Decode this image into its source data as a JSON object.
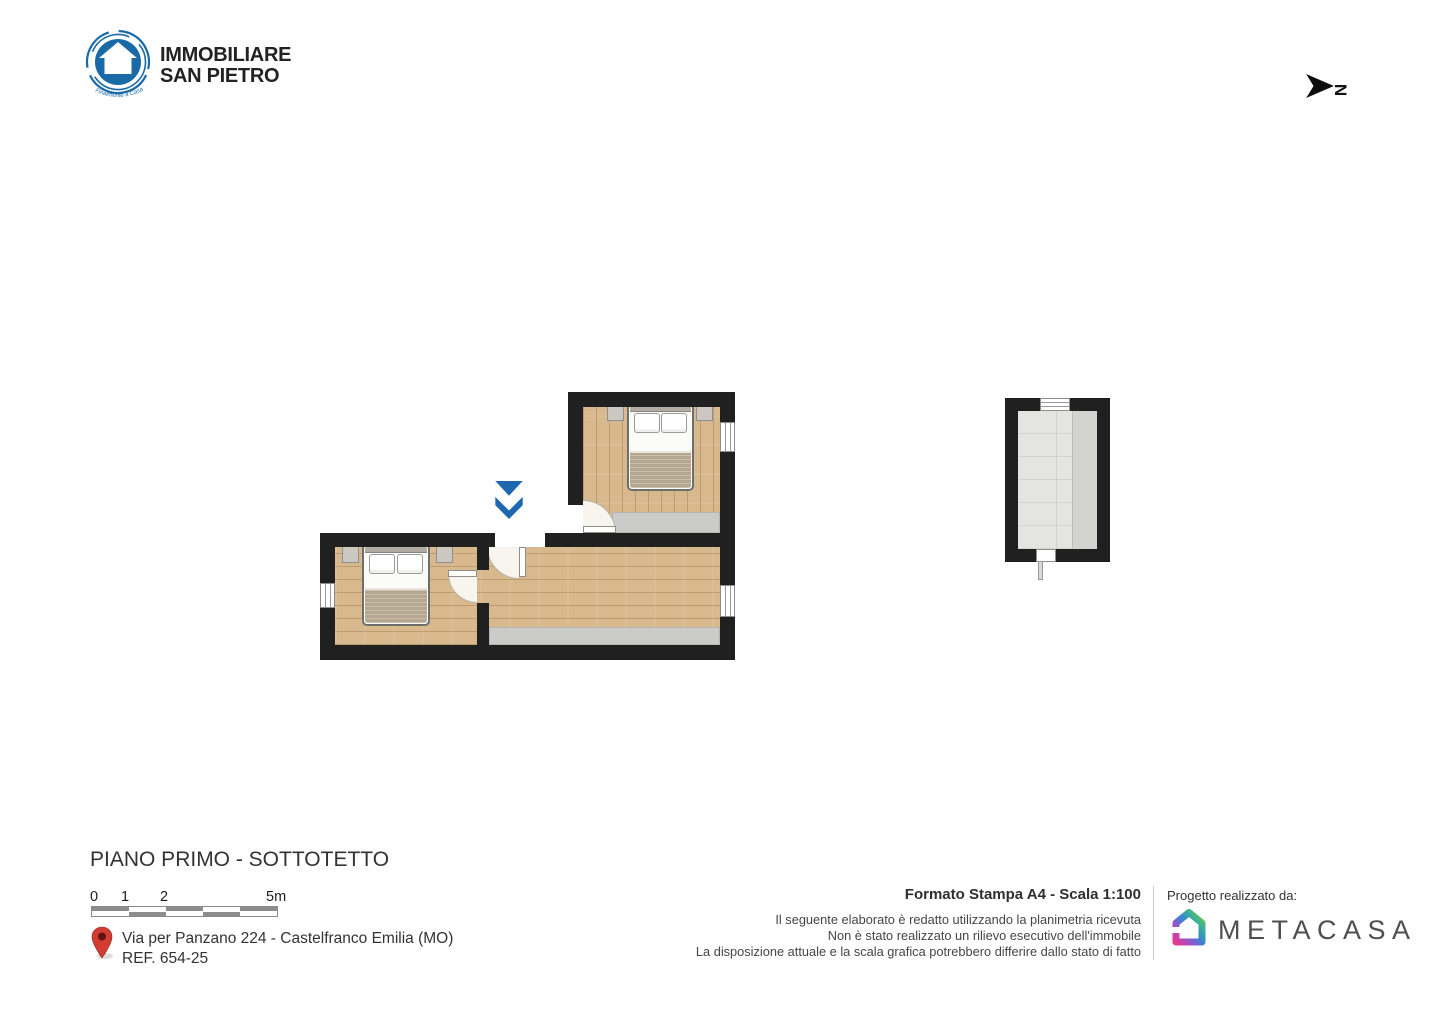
{
  "header": {
    "agency_logo": {
      "line1": "IMMOBILIARE",
      "line2": "SAN PIETRO",
      "tagline": "Finalmente a Casa"
    },
    "north_label": "N"
  },
  "colors": {
    "wall": "#202020",
    "wood_floor": "#d8b88d",
    "low_height_area": "#cbcbc9",
    "tile_floor": "#e4e4e1",
    "entrance_arrow": "#1d68af",
    "brand_blue": "#1a6aa7",
    "pin_red": "#d23c31"
  },
  "footer": {
    "title": "PIANO PRIMO - SOTTOTETTO",
    "scalebar": {
      "labels": [
        "0",
        "1",
        "2",
        "5m"
      ]
    },
    "address": {
      "line1": "Via per Panzano 224 - Castelfranco Emilia (MO)",
      "line2": "REF. 654-25"
    },
    "print_info": {
      "format": "Formato Stampa A4 - Scala 1:100",
      "disclaimers": [
        "Il seguente elaborato è redatto utilizzando la planimetria ricevuta",
        "Non è stato realizzato un rilievo esecutivo dell'immobile",
        "La disposizione attuale e la scala grafica potrebbero differire dallo stato di fatto"
      ]
    },
    "credit": {
      "label": "Progetto realizzato da:",
      "brand": "METACASA"
    }
  }
}
